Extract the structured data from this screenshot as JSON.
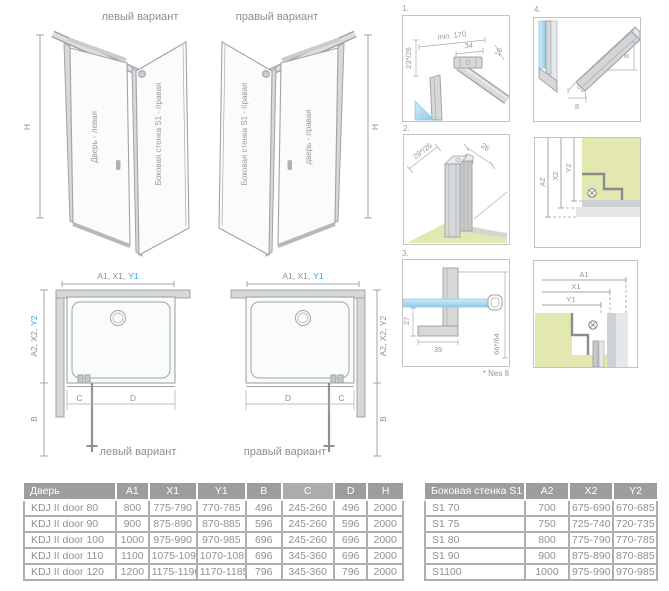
{
  "colors": {
    "accent": "#2bace3",
    "line": "#a0a4a8",
    "floor": "#e3e7b0",
    "glass": "#abd9ee",
    "header_bg": "#9d9d9d",
    "header_highlight": "#acacac",
    "table_border": "#aeaeae"
  },
  "iso_left": {
    "title": "левый вариант",
    "door_label": "Дверь - левая",
    "wall_label": "Боковая стенка S1 - правая",
    "h": "H"
  },
  "iso_right": {
    "title": "правый вариант",
    "door_label": "дверь - правая",
    "wall_label": "Боковая стенка S1 - правая",
    "h": "H"
  },
  "plan_left": {
    "caption": "левый вариант",
    "top_dim": "A1, X1,",
    "top_dim_accent": "Y1",
    "side_dim": "A2, X2,",
    "side_dim_accent": "Y2",
    "b": "B",
    "c": "C",
    "d": "D"
  },
  "plan_right": {
    "caption": "правый вариант",
    "top_dim": "A1, X1,",
    "top_dim_accent": "Y1",
    "side_dim": "A2, X2, Y2",
    "b": "B",
    "c": "C",
    "d": "D"
  },
  "details": {
    "d1": {
      "num": "1.",
      "dim_angle": "23*/26",
      "dim_min": "min. 170",
      "dim_34": "34",
      "dim_16": "16"
    },
    "d2": {
      "num": "2.",
      "dim_a": "28*/26",
      "dim_b": "26"
    },
    "d3": {
      "num": "3.",
      "dim_27": "27",
      "dim_39": "39",
      "dim_66": "66*/64",
      "note": "* Nes 8"
    },
    "d4": {
      "num": "4.",
      "dim_w": "8",
      "dim_h": "8"
    },
    "da2": {
      "a2": "A2",
      "x2": "X2",
      "y2": "Y2"
    },
    "da1": {
      "a1": "A1",
      "x1": "X1",
      "y1": "Y1"
    }
  },
  "door_table": {
    "highlight_col": 5,
    "headers": [
      "Дверь",
      "A1",
      "X1",
      "Y1",
      "B",
      "C",
      "D",
      "H"
    ],
    "rows": [
      [
        "KDJ II door 80",
        "800",
        "775-790",
        "770-785",
        "496",
        "245-260",
        "496",
        "2000"
      ],
      [
        "KDJ II door 90",
        "900",
        "875-890",
        "870-885",
        "596",
        "245-260",
        "596",
        "2000"
      ],
      [
        "KDJ II door 100",
        "1000",
        "975-990",
        "970-985",
        "696",
        "245-260",
        "696",
        "2000"
      ],
      [
        "KDJ II door 110",
        "1100",
        "1075-1090",
        "1070-1085",
        "696",
        "345-360",
        "696",
        "2000"
      ],
      [
        "KDJ II door 120",
        "1200",
        "1175-1190",
        "1170-1185",
        "796",
        "345-360",
        "796",
        "2000"
      ]
    ]
  },
  "wall_table": {
    "headers": [
      "Боковая стенка S1",
      "A2",
      "X2",
      "Y2"
    ],
    "rows": [
      [
        "S1 70",
        "700",
        "675-690",
        "670-685"
      ],
      [
        "S1 75",
        "750",
        "725-740",
        "720-735"
      ],
      [
        "S1 80",
        "800",
        "775-790",
        "770-785"
      ],
      [
        "S1 90",
        "900",
        "875-890",
        "870-885"
      ],
      [
        "S1100",
        "1000",
        "975-990",
        "970-985"
      ]
    ]
  }
}
